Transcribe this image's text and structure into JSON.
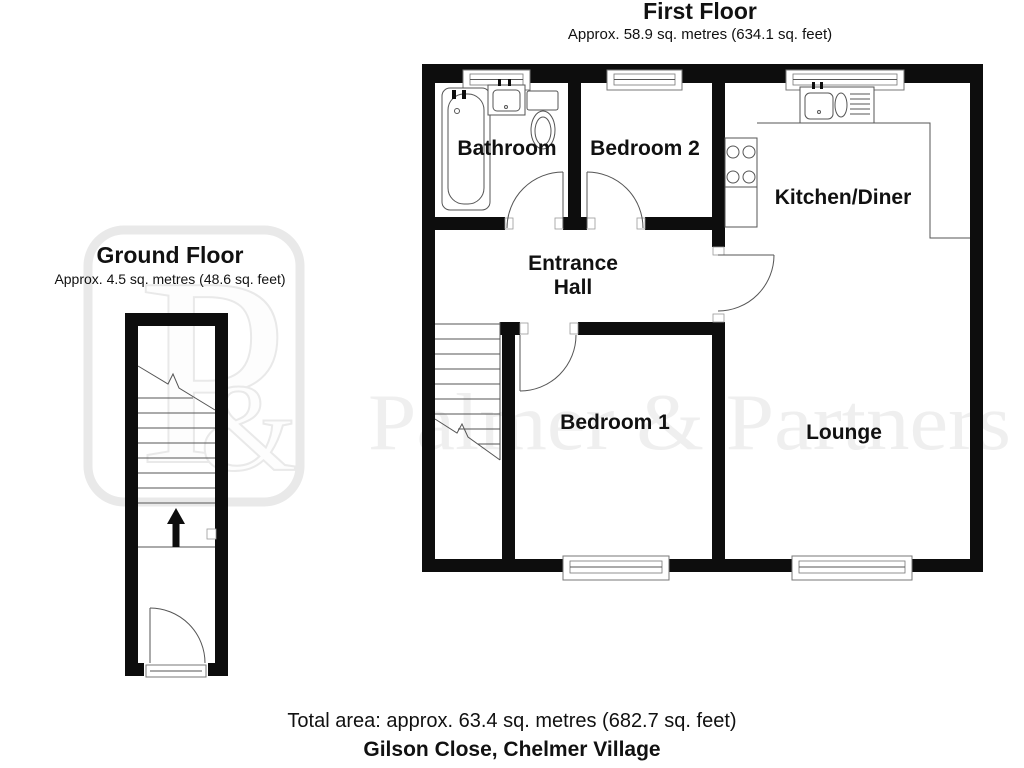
{
  "first_floor": {
    "title": "First Floor",
    "area": "Approx. 58.9 sq. metres (634.1 sq. feet)",
    "rooms": {
      "bathroom": "Bathroom",
      "bedroom2": "Bedroom 2",
      "kitchen": "Kitchen/Diner",
      "hall_line1": "Entrance",
      "hall_line2": "Hall",
      "bedroom1": "Bedroom 1",
      "lounge": "Lounge"
    }
  },
  "ground_floor": {
    "title": "Ground Floor",
    "area": "Approx. 4.5 sq. metres (48.6 sq. feet)"
  },
  "footer": {
    "total_area": "Total area: approx. 63.4 sq. metres (682.7 sq. feet)",
    "address": "Gilson Close, Chelmer Village"
  },
  "watermark": {
    "brand": "Palmer & Partners",
    "monogram_p": "P",
    "monogram_amp": "&"
  },
  "colors": {
    "wall": "#0d0d0d",
    "line": "#555555",
    "watermark": "#efefef",
    "ink": "#111111"
  }
}
